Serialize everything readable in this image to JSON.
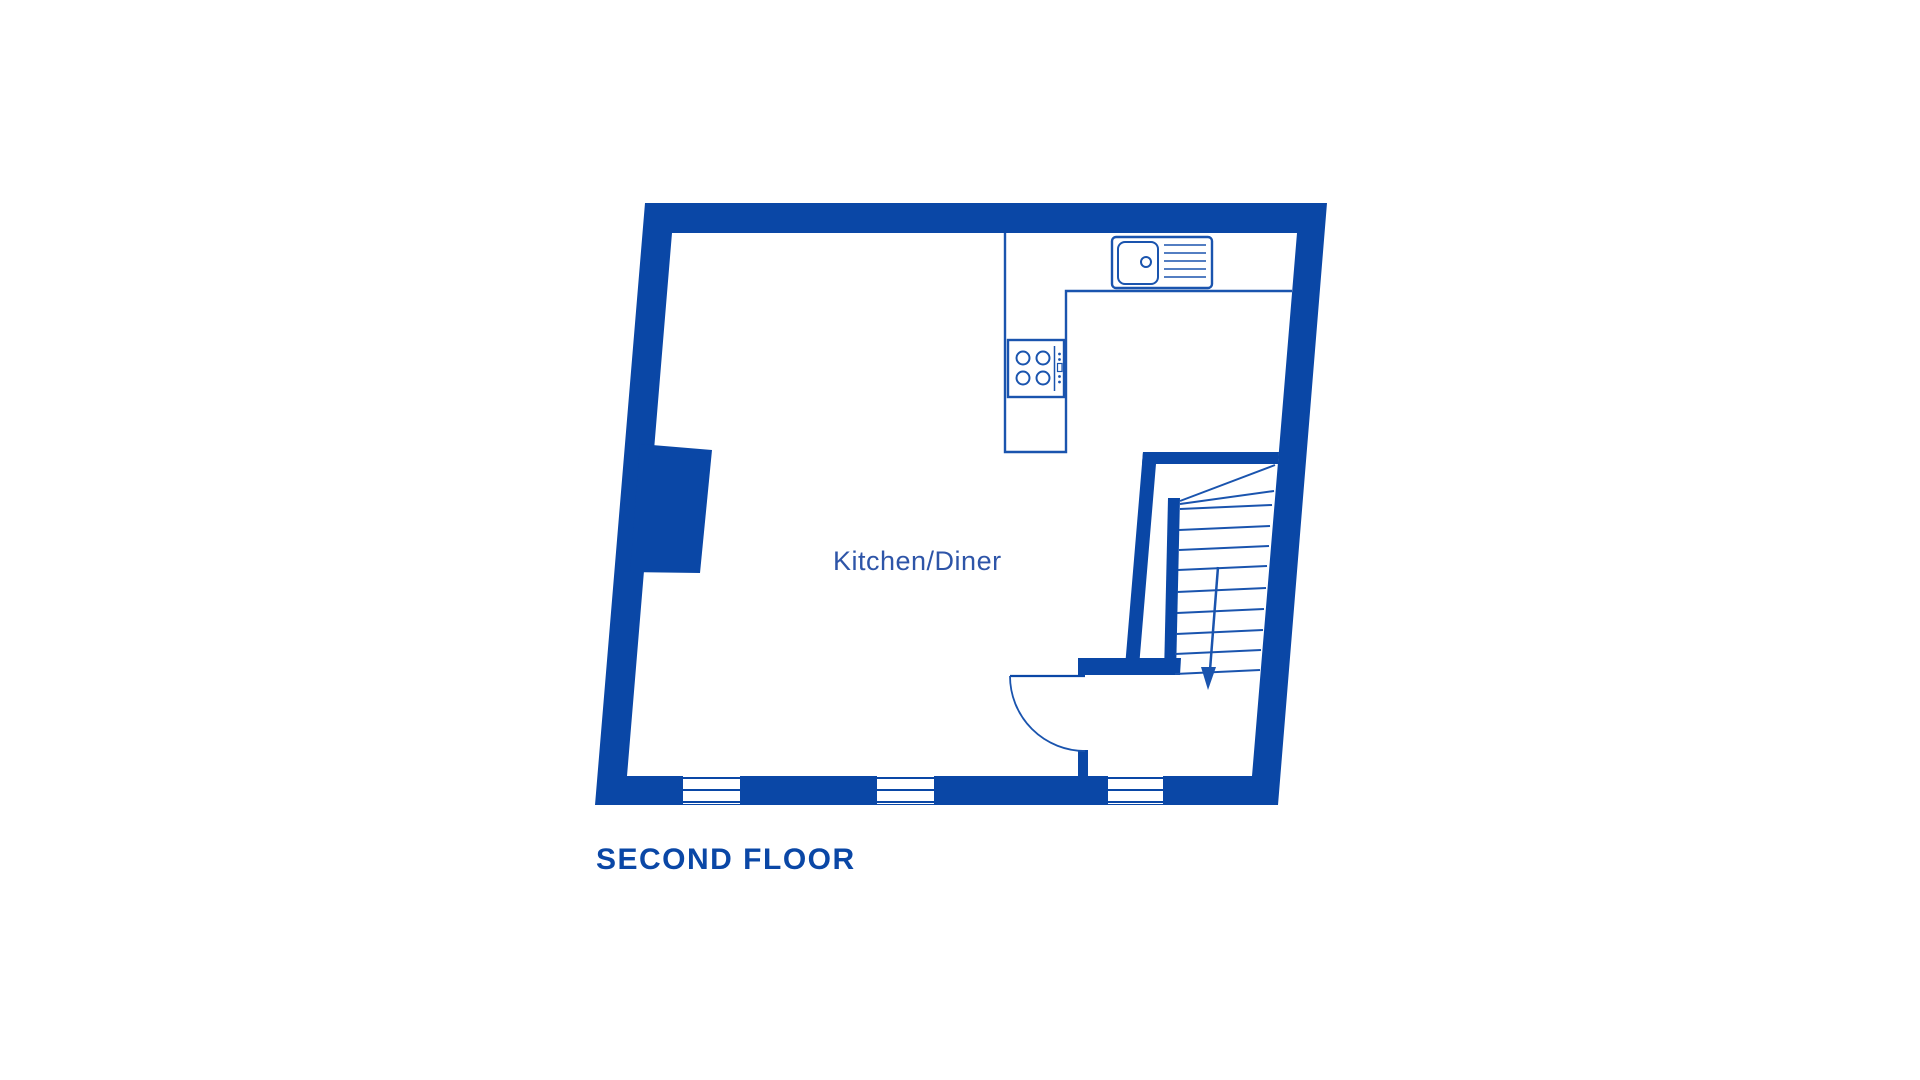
{
  "floorplan": {
    "floor_label": "SECOND FLOOR",
    "room_label": "Kitchen/Diner",
    "fixtures": [
      "sink-with-drainer",
      "four-ring-hob",
      "kitchen-counter",
      "staircase-with-winders",
      "stairs-down-arrow",
      "door-swing-arc",
      "window",
      "window",
      "window",
      "wall-pillar"
    ],
    "colors": {
      "wall": "#0A47A6",
      "fixture_line": "#1A54AE",
      "room_label_text": "#2E55A8",
      "floor_label_text": "#0A47A6",
      "background": "#FFFFFF"
    }
  }
}
